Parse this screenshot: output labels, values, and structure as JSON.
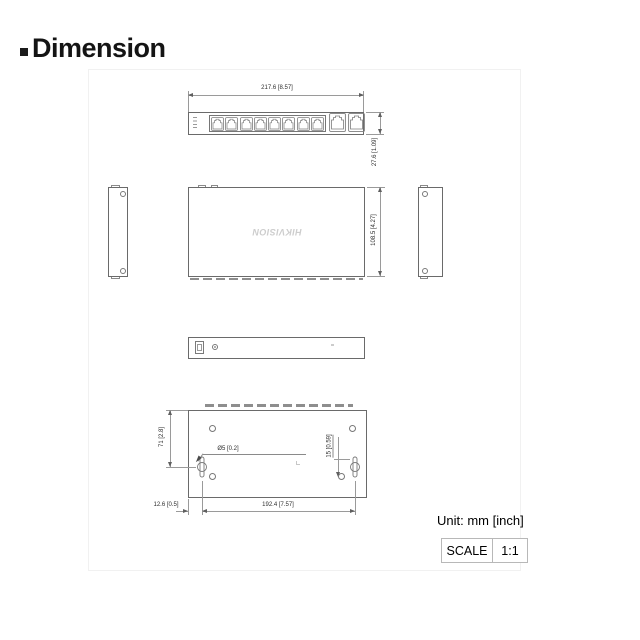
{
  "title": {
    "text": "Dimension"
  },
  "front_view": {
    "width_dim": "217.6  [8.57]",
    "height_dim": "27.6  [1.09]"
  },
  "top_view": {
    "logo": "HIKVISION",
    "depth_dim": "108.5  [4.27]"
  },
  "bottom_view": {
    "left_dim": "71  [2.8]",
    "hole_dim": "Ø5  [0.2]",
    "slot_dim": "15  [0.59]",
    "offset_dim": "12.6  [0.5]",
    "span_dim": "192.4  [7.57]"
  },
  "footer": {
    "unit_label": "Unit: mm [inch]",
    "scale_label": "SCALE",
    "scale_value": "1:1"
  }
}
